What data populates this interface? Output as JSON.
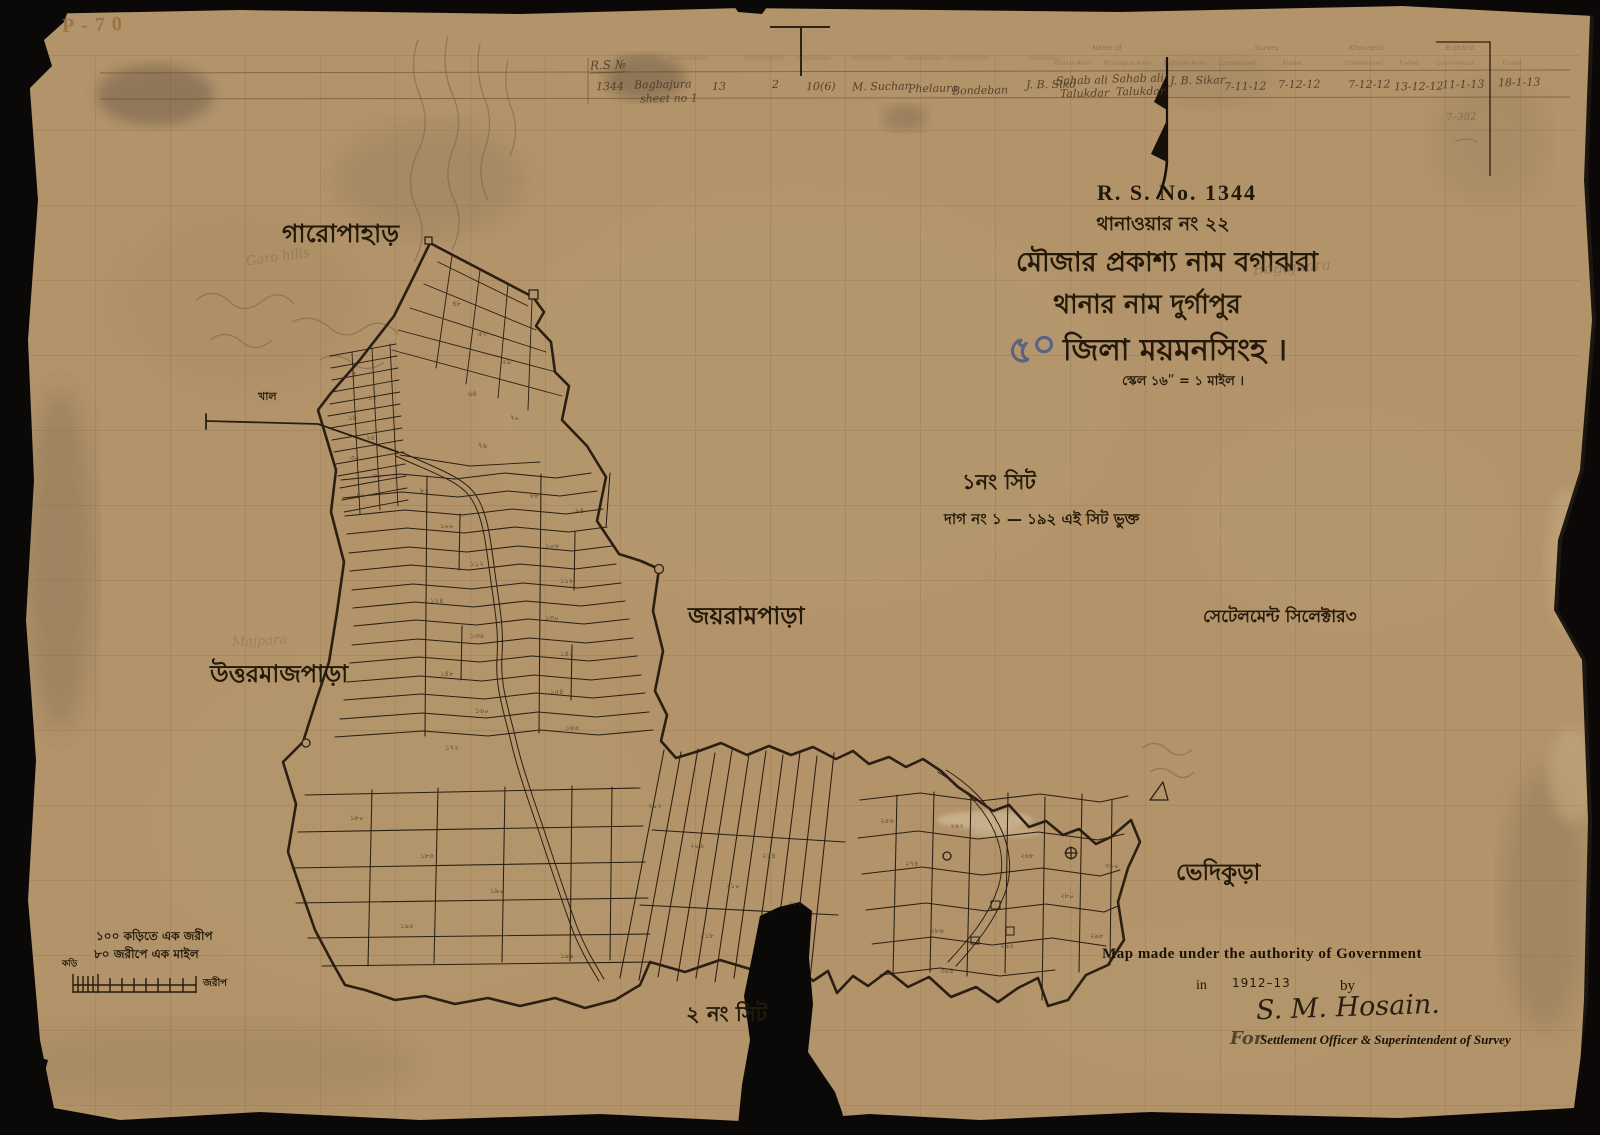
{
  "meta": {
    "stamp": "P-70",
    "pencil_note": "7–382"
  },
  "title_block": {
    "rs_no": "R. S. No. 1344",
    "thana_no_line": "থানাওয়ার নং ২২",
    "mouza_line": "মৌজার প্রকাশ্য নাম বগাঝরা",
    "mouza_pencil": "Bagajhara",
    "thana_line": "থানার নাম দুর্গাপুর",
    "district_line": "জিলা ময়মনসিংহ ।",
    "scale_line": "স্কেল ১৬ʺ = ১ মাইল ।",
    "blue_mark": "৫০"
  },
  "sheet_notes": {
    "sheet1": "১নং সিট",
    "sheet1_plots": "দাগ নং ১ — ১৯২ এই সিট ভুক্ত",
    "sheet2": "২ নং সিট"
  },
  "place_names": {
    "garopahar": "গারোপাহাড়",
    "garopahar_pencil": "Garo hills",
    "khal": "খাল",
    "uttarmajpara": "উত্তরমাজপাড়া",
    "majpara_pencil": "Majpara",
    "jayrampara": "জয়রামপাড়া",
    "settlement_mark": "সেটেলমেন্ট সিলেক্টার৩",
    "bhedikura": "ভেদিকুড়া"
  },
  "scale_bar": {
    "line1": "১০০ কড়িতে এক জরীপ",
    "line2": "৮০ জরীপে এক মাইল",
    "unit_left": "কড়ি",
    "unit_right": "জরীপ"
  },
  "attribution": {
    "line1": "Map made under the authority of Government",
    "in_word": "in",
    "years": "1912–13",
    "by_word": "by",
    "signature": "S. M. Hosain.",
    "for_word": "For",
    "line2": "Settlement Officer & Superintendent of Survey"
  },
  "survey_table": {
    "rs_label": "R.S №",
    "group_headers": [
      {
        "text": "Name of",
        "x": 1107,
        "y": 44
      },
      {
        "text": "Survey",
        "x": 1267,
        "y": 44
      },
      {
        "text": "Khanapuri",
        "x": 1367,
        "y": 44
      },
      {
        "text": "Bujharat",
        "x": 1460,
        "y": 44
      }
    ],
    "sub_headers": [
      {
        "text": "Khasra Amin",
        "x": 1073,
        "y": 60
      },
      {
        "text": "Khanapuri Amin",
        "x": 1128,
        "y": 60
      },
      {
        "text": "Bujharat Amin",
        "x": 1185,
        "y": 60
      },
      {
        "text": "Commenced",
        "x": 1237,
        "y": 60
      },
      {
        "text": "Ended",
        "x": 1292,
        "y": 60
      },
      {
        "text": "Commenced",
        "x": 1364,
        "y": 60
      },
      {
        "text": "Ended",
        "x": 1409,
        "y": 60
      },
      {
        "text": "Commenced",
        "x": 1455,
        "y": 60
      },
      {
        "text": "Ended",
        "x": 1512,
        "y": 60
      }
    ],
    "cells": [
      {
        "t": "1344",
        "x": 596,
        "y": 80
      },
      {
        "t": "Bagbajura",
        "x": 634,
        "y": 78
      },
      {
        "t": "sheet no 1",
        "x": 640,
        "y": 92
      },
      {
        "t": "13",
        "x": 712,
        "y": 80
      },
      {
        "t": "2",
        "x": 772,
        "y": 78
      },
      {
        "t": "10(6)",
        "x": 806,
        "y": 80
      },
      {
        "t": "M. Suchar",
        "x": 852,
        "y": 80
      },
      {
        "t": "Phelaura",
        "x": 908,
        "y": 82
      },
      {
        "t": "Bondeban",
        "x": 952,
        "y": 84
      },
      {
        "t": "J. B. Sikd",
        "x": 1026,
        "y": 78
      },
      {
        "t": "Sahab ali",
        "x": 1056,
        "y": 74
      },
      {
        "t": "Talukdar",
        "x": 1060,
        "y": 87
      },
      {
        "t": "Sahab ali",
        "x": 1112,
        "y": 72
      },
      {
        "t": "Talukdar",
        "x": 1116,
        "y": 85
      },
      {
        "t": "J. B. Sikar",
        "x": 1170,
        "y": 74
      },
      {
        "t": "7-11-12",
        "x": 1224,
        "y": 80
      },
      {
        "t": "7-12-12",
        "x": 1278,
        "y": 78
      },
      {
        "t": "7-12-12",
        "x": 1348,
        "y": 78
      },
      {
        "t": "13-12-12",
        "x": 1394,
        "y": 80
      },
      {
        "t": "11-1-13",
        "x": 1442,
        "y": 78
      },
      {
        "t": "18-1-13",
        "x": 1498,
        "y": 76
      }
    ]
  },
  "plot_numbers": [
    {
      "n": "৫",
      "x": 352,
      "y": 368
    },
    {
      "n": "১২",
      "x": 368,
      "y": 392
    },
    {
      "n": "১৮",
      "x": 348,
      "y": 412
    },
    {
      "n": "২৪",
      "x": 366,
      "y": 432
    },
    {
      "n": "৩০",
      "x": 350,
      "y": 452
    },
    {
      "n": "৩৬",
      "x": 372,
      "y": 470
    },
    {
      "n": "৪২",
      "x": 356,
      "y": 490
    },
    {
      "n": "৪৮",
      "x": 452,
      "y": 298
    },
    {
      "n": "৫৩",
      "x": 478,
      "y": 328
    },
    {
      "n": "৫৯",
      "x": 502,
      "y": 356
    },
    {
      "n": "৬৪",
      "x": 468,
      "y": 388
    },
    {
      "n": "৭০",
      "x": 510,
      "y": 412
    },
    {
      "n": "৭৬",
      "x": 478,
      "y": 440
    },
    {
      "n": "৮২",
      "x": 420,
      "y": 485
    },
    {
      "n": "৮৮",
      "x": 530,
      "y": 490
    },
    {
      "n": "৯৪",
      "x": 575,
      "y": 505
    },
    {
      "n": "১০০",
      "x": 440,
      "y": 520
    },
    {
      "n": "১০৬",
      "x": 545,
      "y": 540
    },
    {
      "n": "১১২",
      "x": 470,
      "y": 558
    },
    {
      "n": "১১৮",
      "x": 560,
      "y": 575
    },
    {
      "n": "১২৪",
      "x": 430,
      "y": 595
    },
    {
      "n": "১৩০",
      "x": 545,
      "y": 612
    },
    {
      "n": "১৩৬",
      "x": 470,
      "y": 630
    },
    {
      "n": "১৪২",
      "x": 560,
      "y": 648
    },
    {
      "n": "১৪৮",
      "x": 440,
      "y": 668
    },
    {
      "n": "১৫৪",
      "x": 550,
      "y": 686
    },
    {
      "n": "১৬০",
      "x": 475,
      "y": 705
    },
    {
      "n": "১৬৬",
      "x": 565,
      "y": 722
    },
    {
      "n": "১৭২",
      "x": 445,
      "y": 742
    },
    {
      "n": "২০২",
      "x": 648,
      "y": 800
    },
    {
      "n": "২০৬",
      "x": 690,
      "y": 840
    },
    {
      "n": "২১০",
      "x": 726,
      "y": 880
    },
    {
      "n": "২১৪",
      "x": 762,
      "y": 850
    },
    {
      "n": "২১৮",
      "x": 700,
      "y": 930
    },
    {
      "n": "২২২",
      "x": 788,
      "y": 898
    },
    {
      "n": "১৮০",
      "x": 350,
      "y": 812
    },
    {
      "n": "১৮৬",
      "x": 420,
      "y": 850
    },
    {
      "n": "১৯০",
      "x": 490,
      "y": 885
    },
    {
      "n": "১৯৫",
      "x": 400,
      "y": 920
    },
    {
      "n": "১৯৯",
      "x": 560,
      "y": 950
    },
    {
      "n": "২৫৬",
      "x": 880,
      "y": 815
    },
    {
      "n": "২৬২",
      "x": 950,
      "y": 820
    },
    {
      "n": "২৬৮",
      "x": 1020,
      "y": 850
    },
    {
      "n": "২৭৪",
      "x": 905,
      "y": 858
    },
    {
      "n": "২৮০",
      "x": 1060,
      "y": 890
    },
    {
      "n": "২৮৬",
      "x": 930,
      "y": 925
    },
    {
      "n": "২৯২",
      "x": 1000,
      "y": 940
    },
    {
      "n": "২৯৮",
      "x": 1090,
      "y": 930
    },
    {
      "n": "৩০৪",
      "x": 940,
      "y": 965
    },
    {
      "n": "৩১০",
      "x": 1105,
      "y": 860
    }
  ],
  "colors": {
    "paper": "#b2936a",
    "ink": "#2a1f12",
    "pencil": "#6f5f4a",
    "blue_pencil": "#46568c",
    "tear_black": "#0b0908"
  }
}
